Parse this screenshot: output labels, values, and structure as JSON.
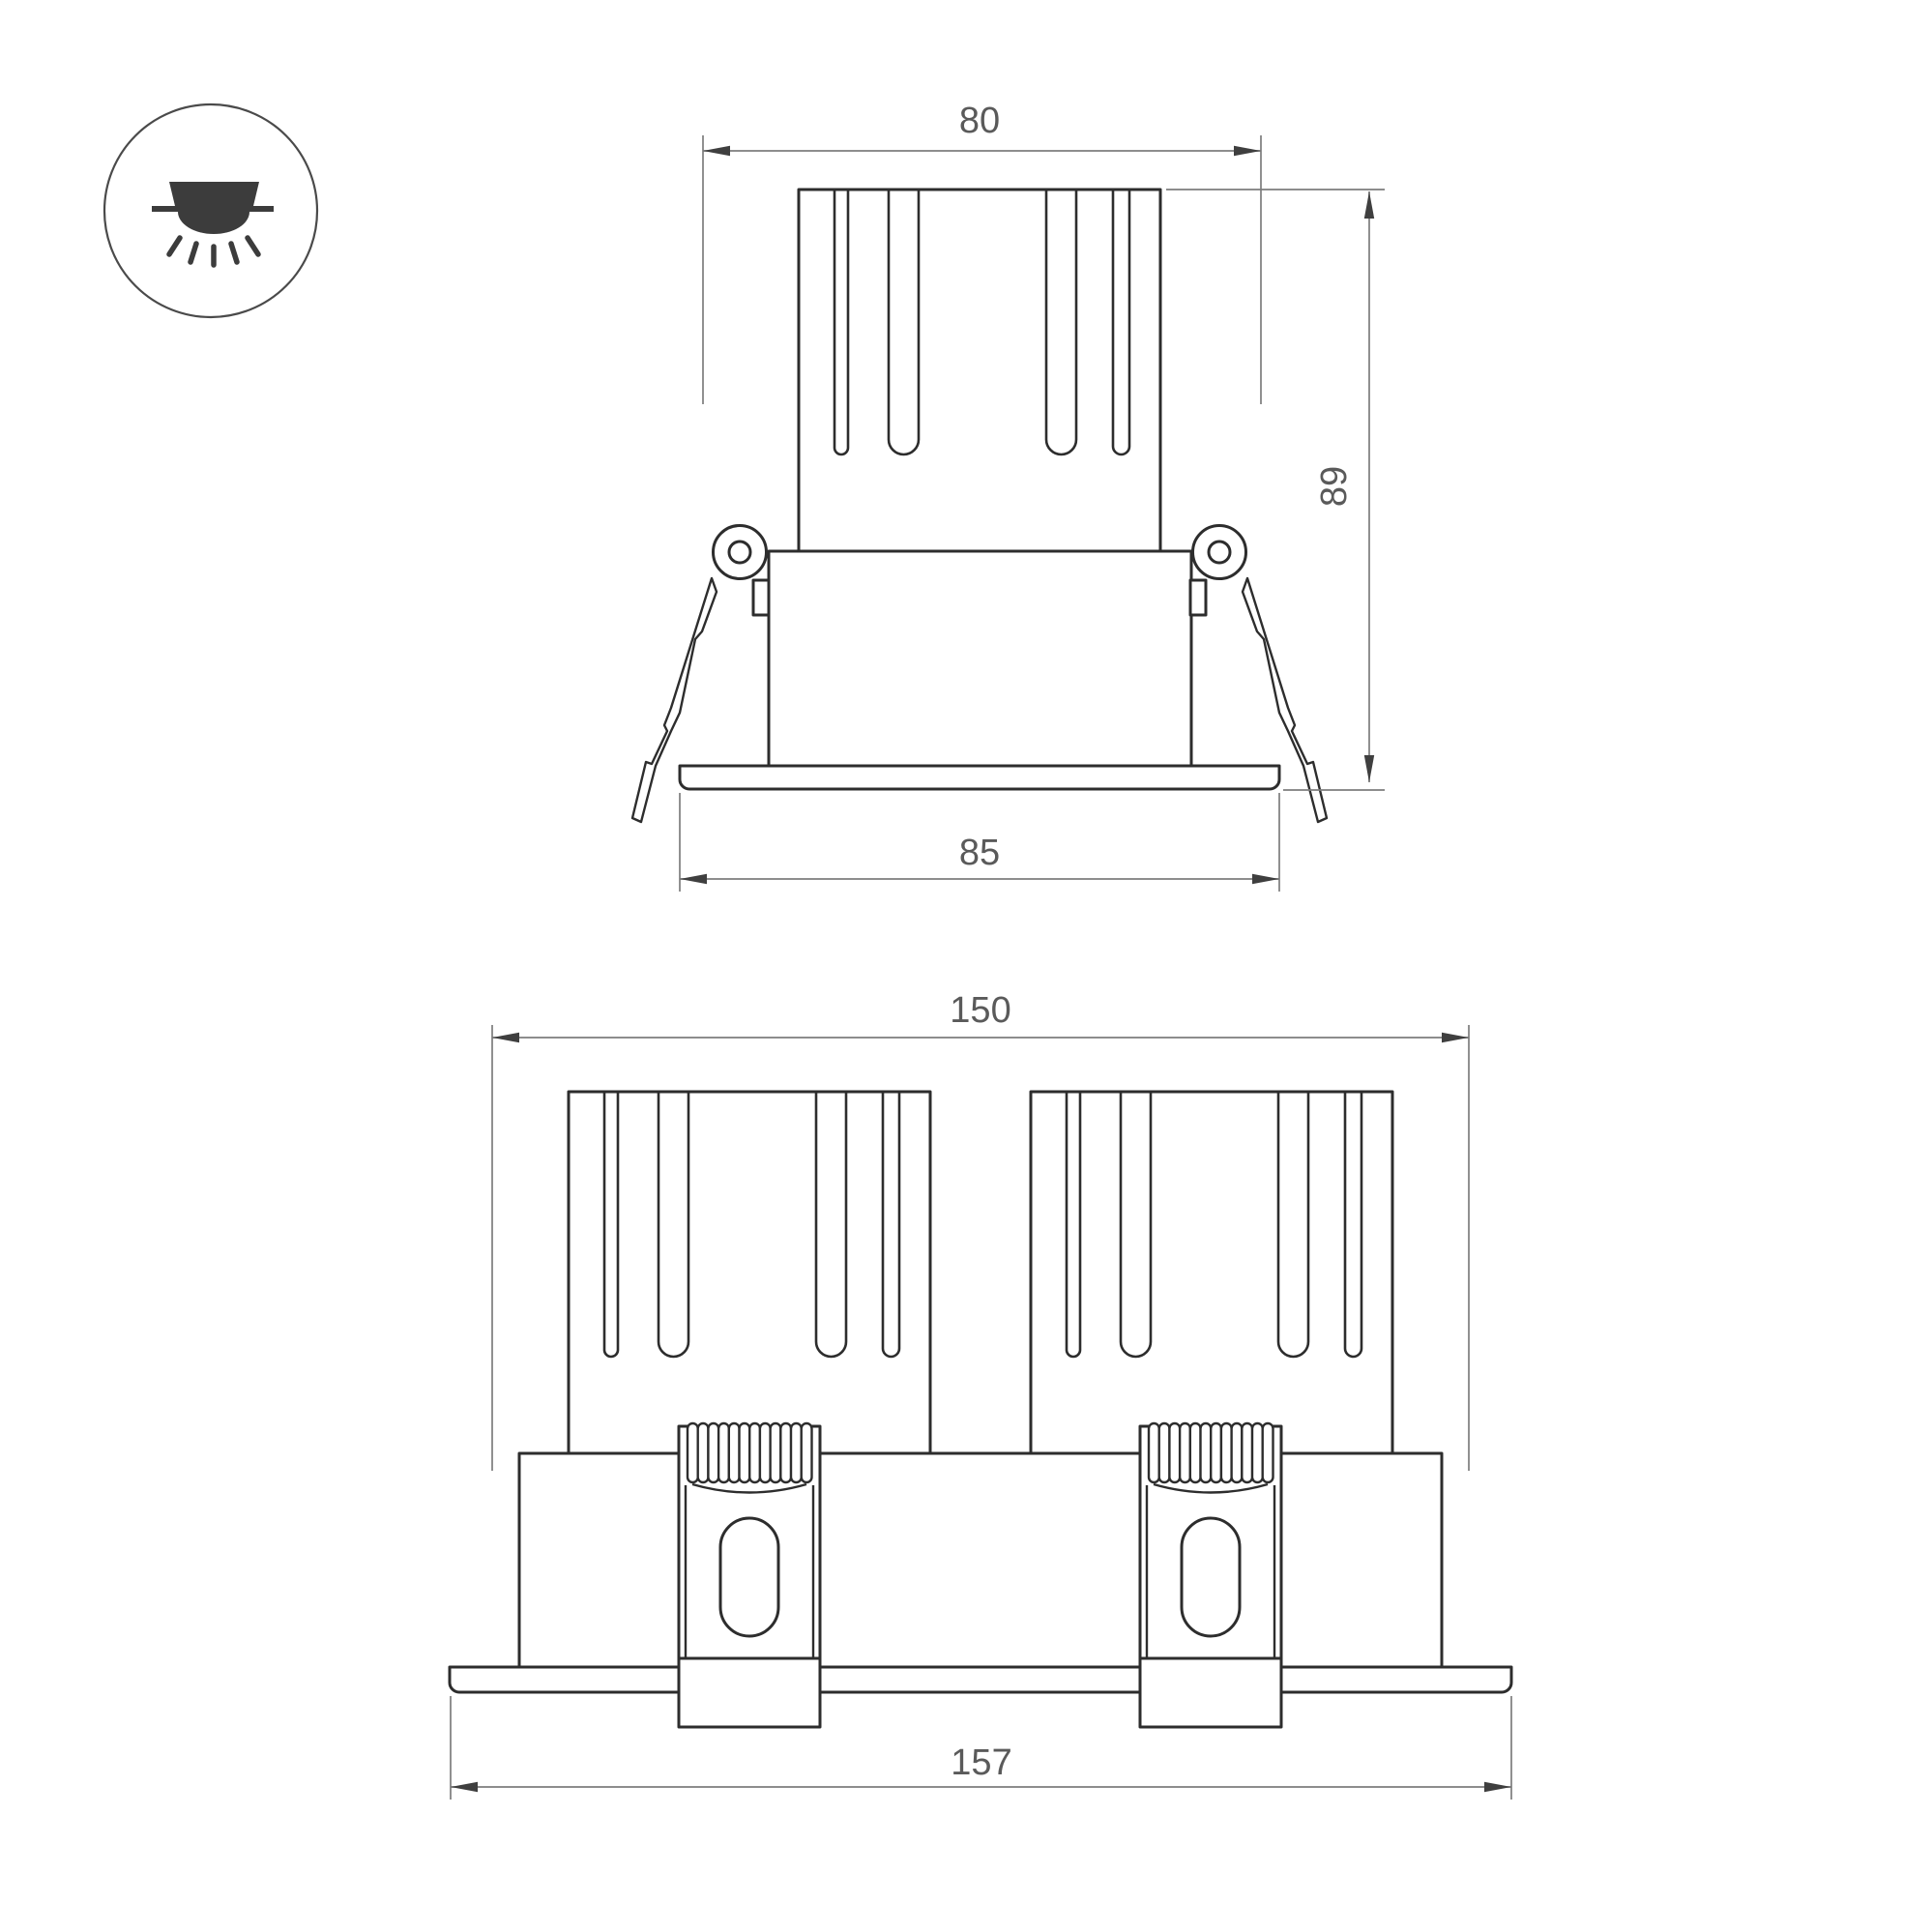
{
  "icon": {
    "name": "recessed-downlight-icon"
  },
  "colors": {
    "background": "#ffffff",
    "outline": "#2d2d2d",
    "dimension_line": "#7d7d7d",
    "arrow": "#3f3f3f",
    "text": "#5a5a5a"
  },
  "views": {
    "front_single": {
      "name": "single-module-front-view",
      "dims": {
        "top_width": "80",
        "height": "89",
        "flange_width": "85"
      }
    },
    "front_double": {
      "name": "dual-module-front-view",
      "dims": {
        "body_width": "150",
        "flange_width": "157"
      }
    }
  }
}
